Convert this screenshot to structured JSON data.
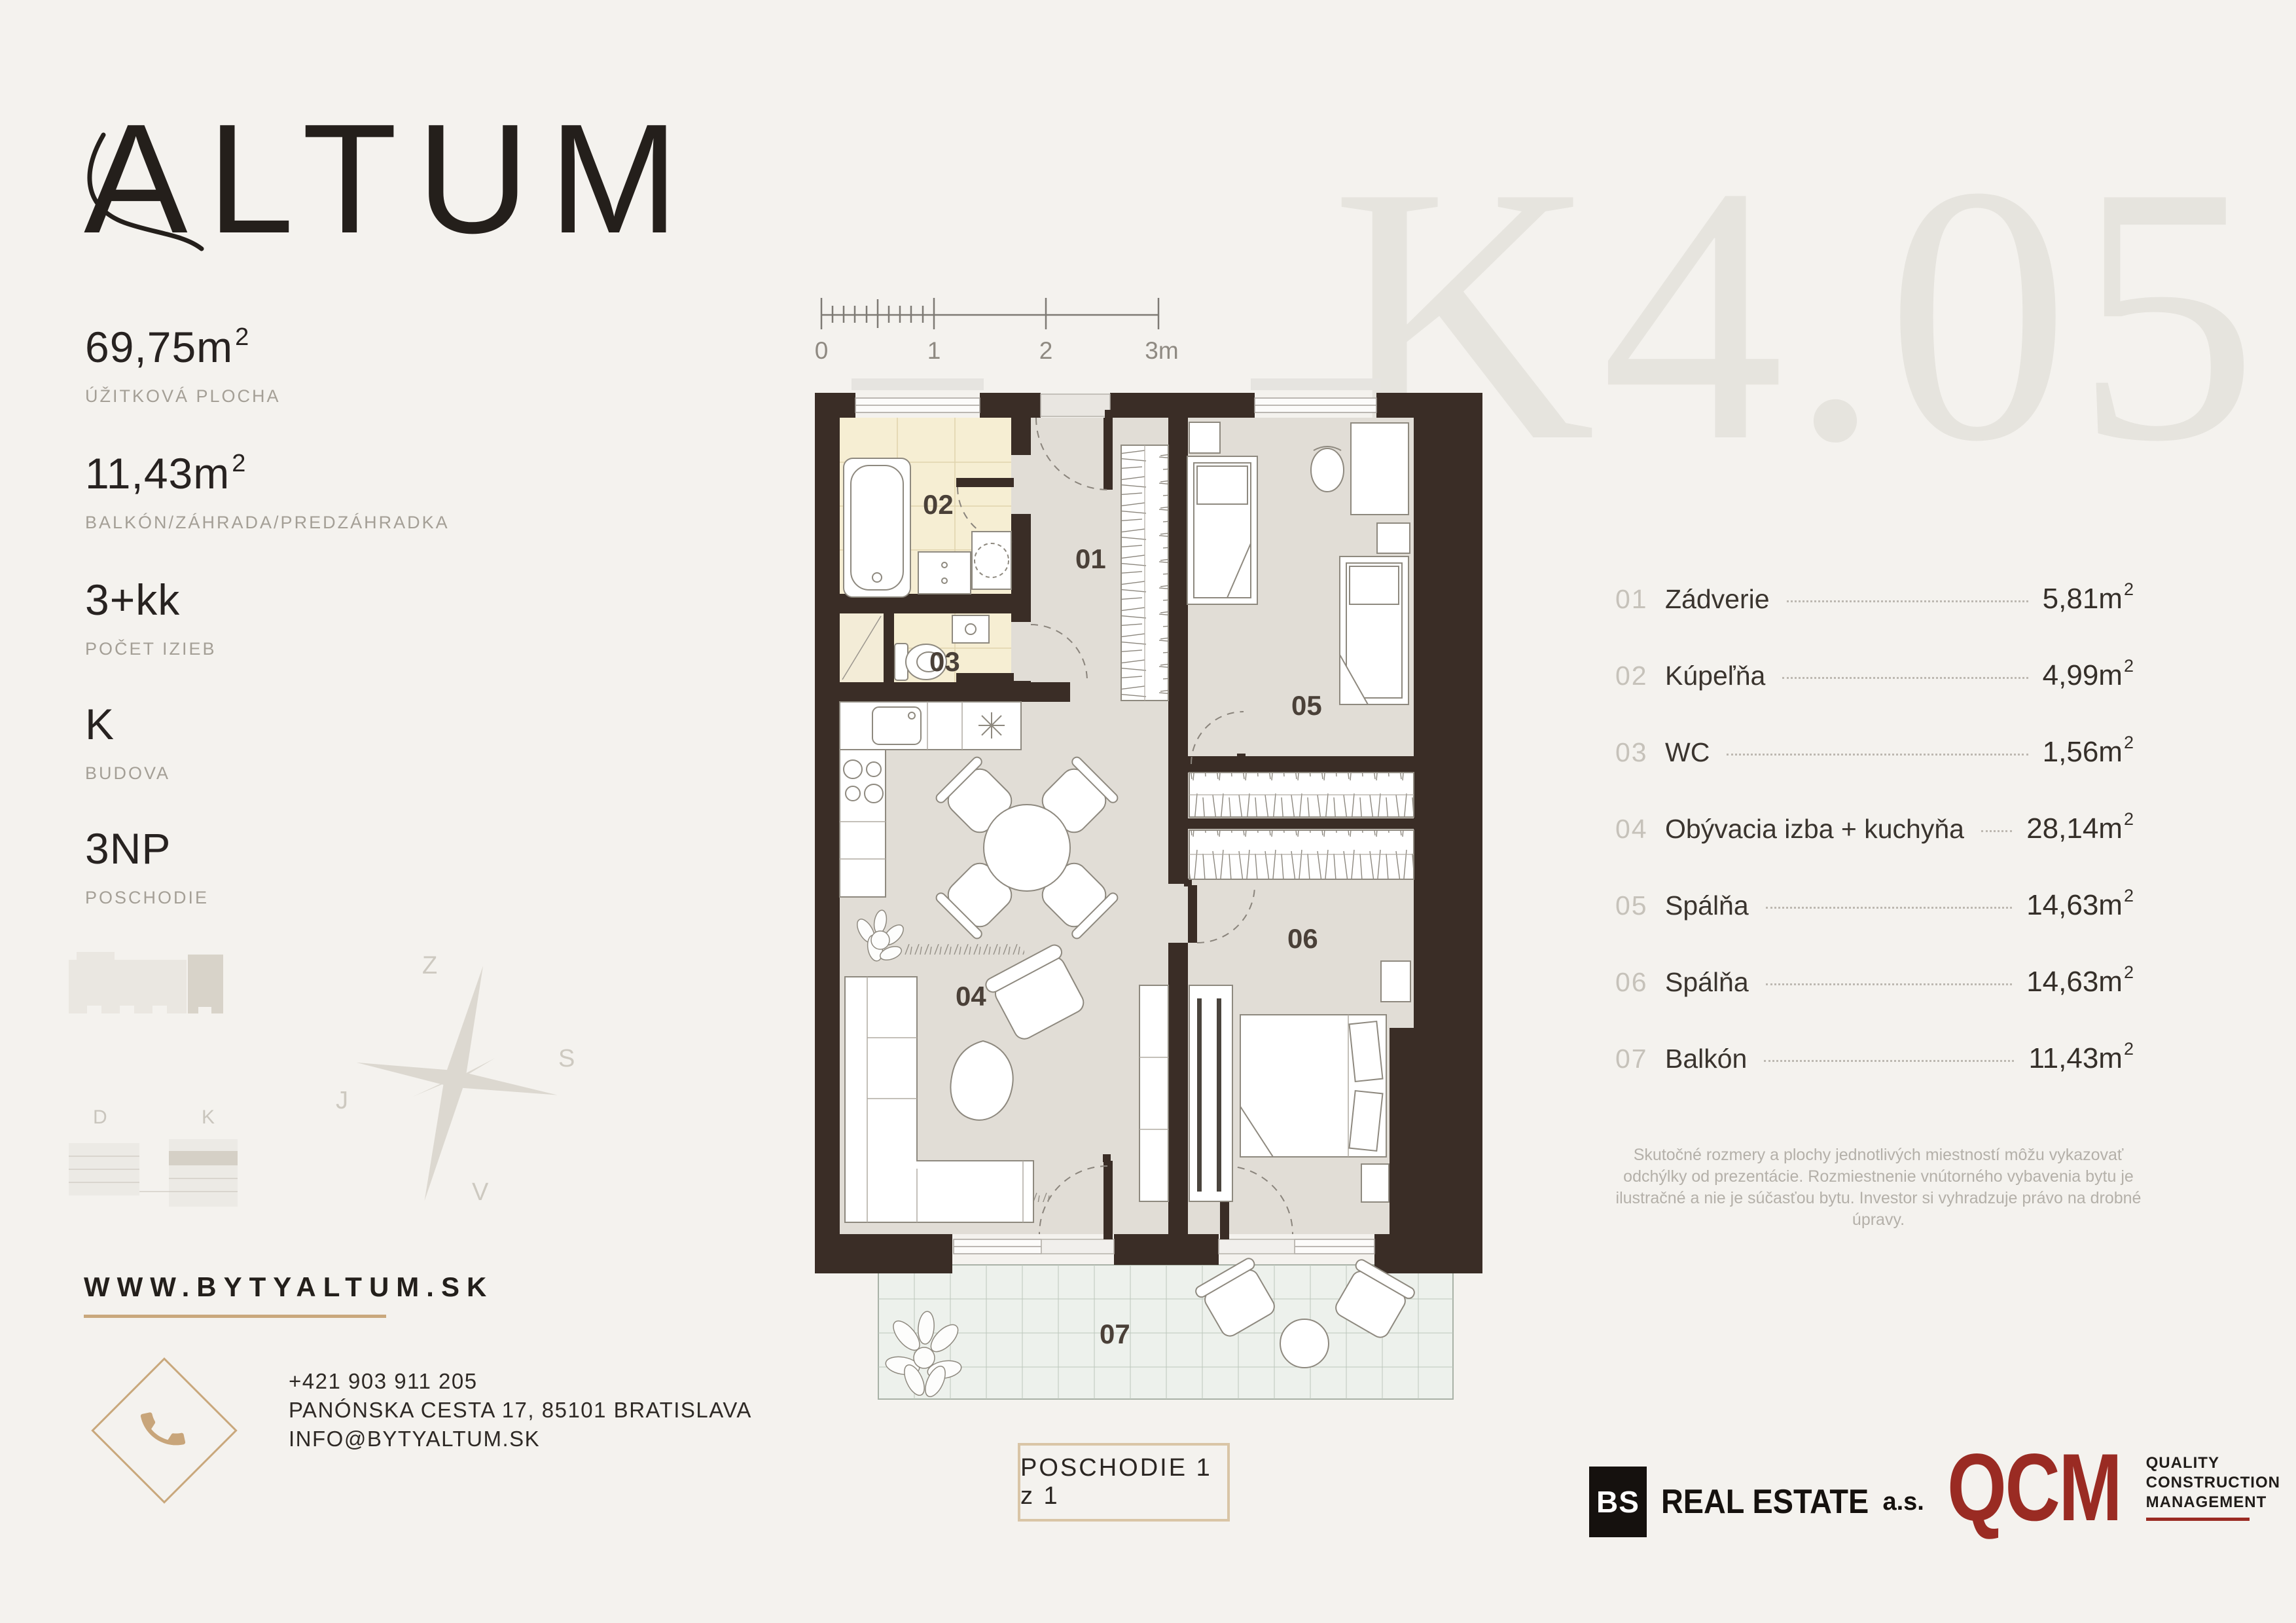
{
  "brand": {
    "name": "ALTUM",
    "website": "WWW.BYTYALTUM.SK"
  },
  "watermark": "K4.05",
  "stats": [
    {
      "value": "69,75m",
      "sup": "2",
      "label": "ÚŽITKOVÁ PLOCHA"
    },
    {
      "value": "11,43m",
      "sup": "2",
      "label": "BALKÓN/ZÁHRADA/PREDZÁHRADKA"
    },
    {
      "value": "3+kk",
      "sup": "",
      "label": "POČET IZIEB"
    },
    {
      "value": "K",
      "sup": "",
      "label": "BUDOVA"
    },
    {
      "value": "3NP",
      "sup": "",
      "label": "POSCHODIE"
    }
  ],
  "scale_bar": {
    "ticks": [
      "0",
      "1",
      "2",
      "3m"
    ]
  },
  "compass": {
    "top": "Z",
    "right": "S",
    "left": "J",
    "bottom": "V"
  },
  "site_plan": {
    "left_label": "D",
    "right_label": "K"
  },
  "contact": {
    "phone": "+421 903 911 205",
    "address": "PANÓNSKA CESTA 17, 85101 BRATISLAVA",
    "email": "INFO@BYTYALTUM.SK"
  },
  "floor_badge": "POSCHODIE 1 z 1",
  "plan_labels": {
    "r01": "01",
    "r02": "02",
    "r03": "03",
    "r04": "04",
    "r05": "05",
    "r06": "06",
    "r07": "07"
  },
  "rooms": [
    {
      "num": "01",
      "name": "Zádverie",
      "area": "5,81m",
      "sup": "2"
    },
    {
      "num": "02",
      "name": "Kúpeľňa",
      "area": "4,99m",
      "sup": "2"
    },
    {
      "num": "03",
      "name": "WC",
      "area": "1,56m",
      "sup": "2"
    },
    {
      "num": "04",
      "name": "Obývacia izba + kuchyňa",
      "area": "28,14m",
      "sup": "2"
    },
    {
      "num": "05",
      "name": "Spálňa",
      "area": "14,63m",
      "sup": "2"
    },
    {
      "num": "06",
      "name": "Spálňa",
      "area": "14,63m",
      "sup": "2"
    },
    {
      "num": "07",
      "name": "Balkón",
      "area": "11,43m",
      "sup": "2"
    }
  ],
  "disclaimer": "Skutočné rozmery a plochy jednotlivých miestností môžu vykazovať odchýlky od prezentácie. Rozmiestnenie vnútorného vybavenia bytu je ilustračné a nie je súčasťou bytu. Investor si vyhradzuje právo na drobné úpravy.",
  "partners": {
    "bs_box": "BS",
    "bs_name": "REAL ESTATE",
    "bs_suffix": "a.s.",
    "qcm": "QCM",
    "qcm_lines": [
      "QUALITY",
      "CONSTRUCTION",
      "MANAGEMENT"
    ]
  },
  "colors": {
    "accent": "#c9a87c",
    "wall": "#3a2d26",
    "qcm_red": "#9a2b23",
    "background": "#f4f2ee"
  }
}
